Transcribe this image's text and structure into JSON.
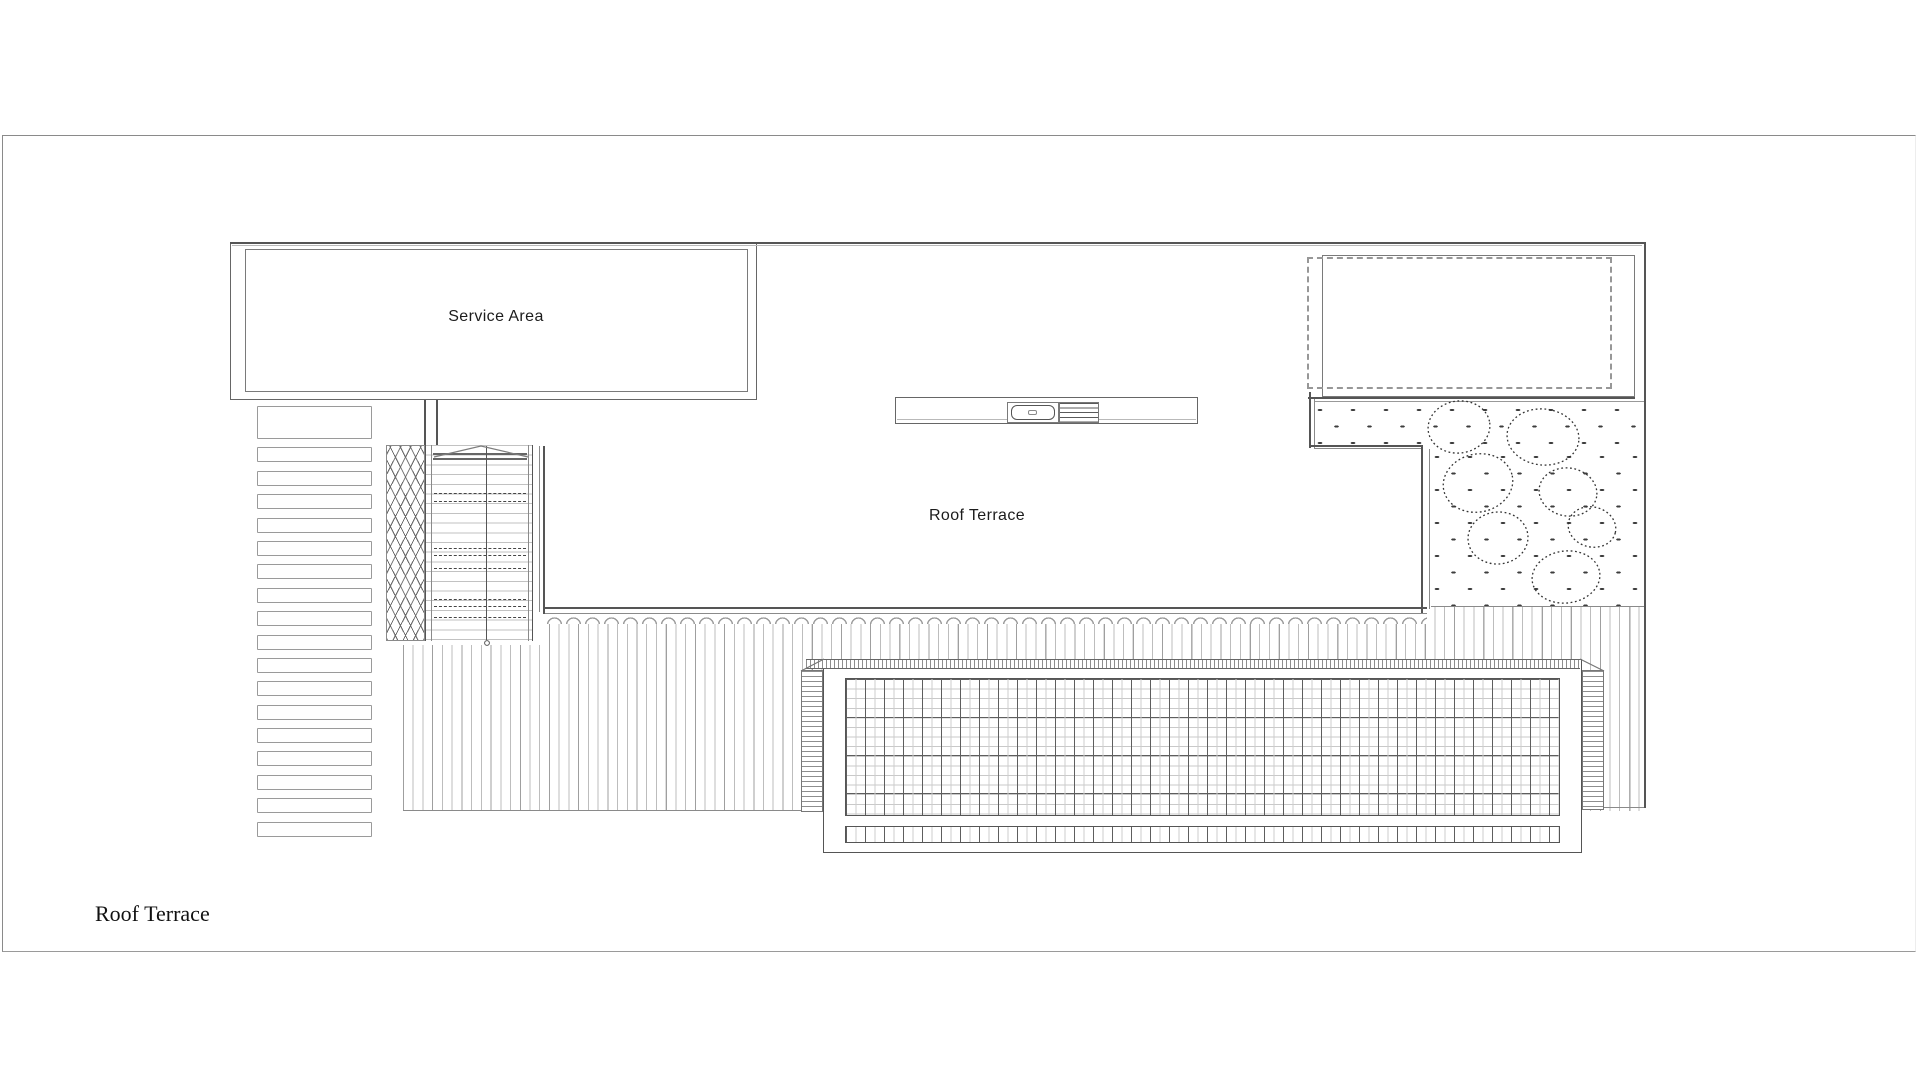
{
  "sheet": {
    "title": "Roof Terrace"
  },
  "labels": {
    "service_area": "Service Area",
    "roof_terrace": "Roof Terrace"
  },
  "palette": {
    "paper": "#ffffff",
    "line_strong": "#555555",
    "line_mid": "#8a8a8a",
    "line_faint": "#c9c9c9",
    "text": "#1c1c1c"
  }
}
